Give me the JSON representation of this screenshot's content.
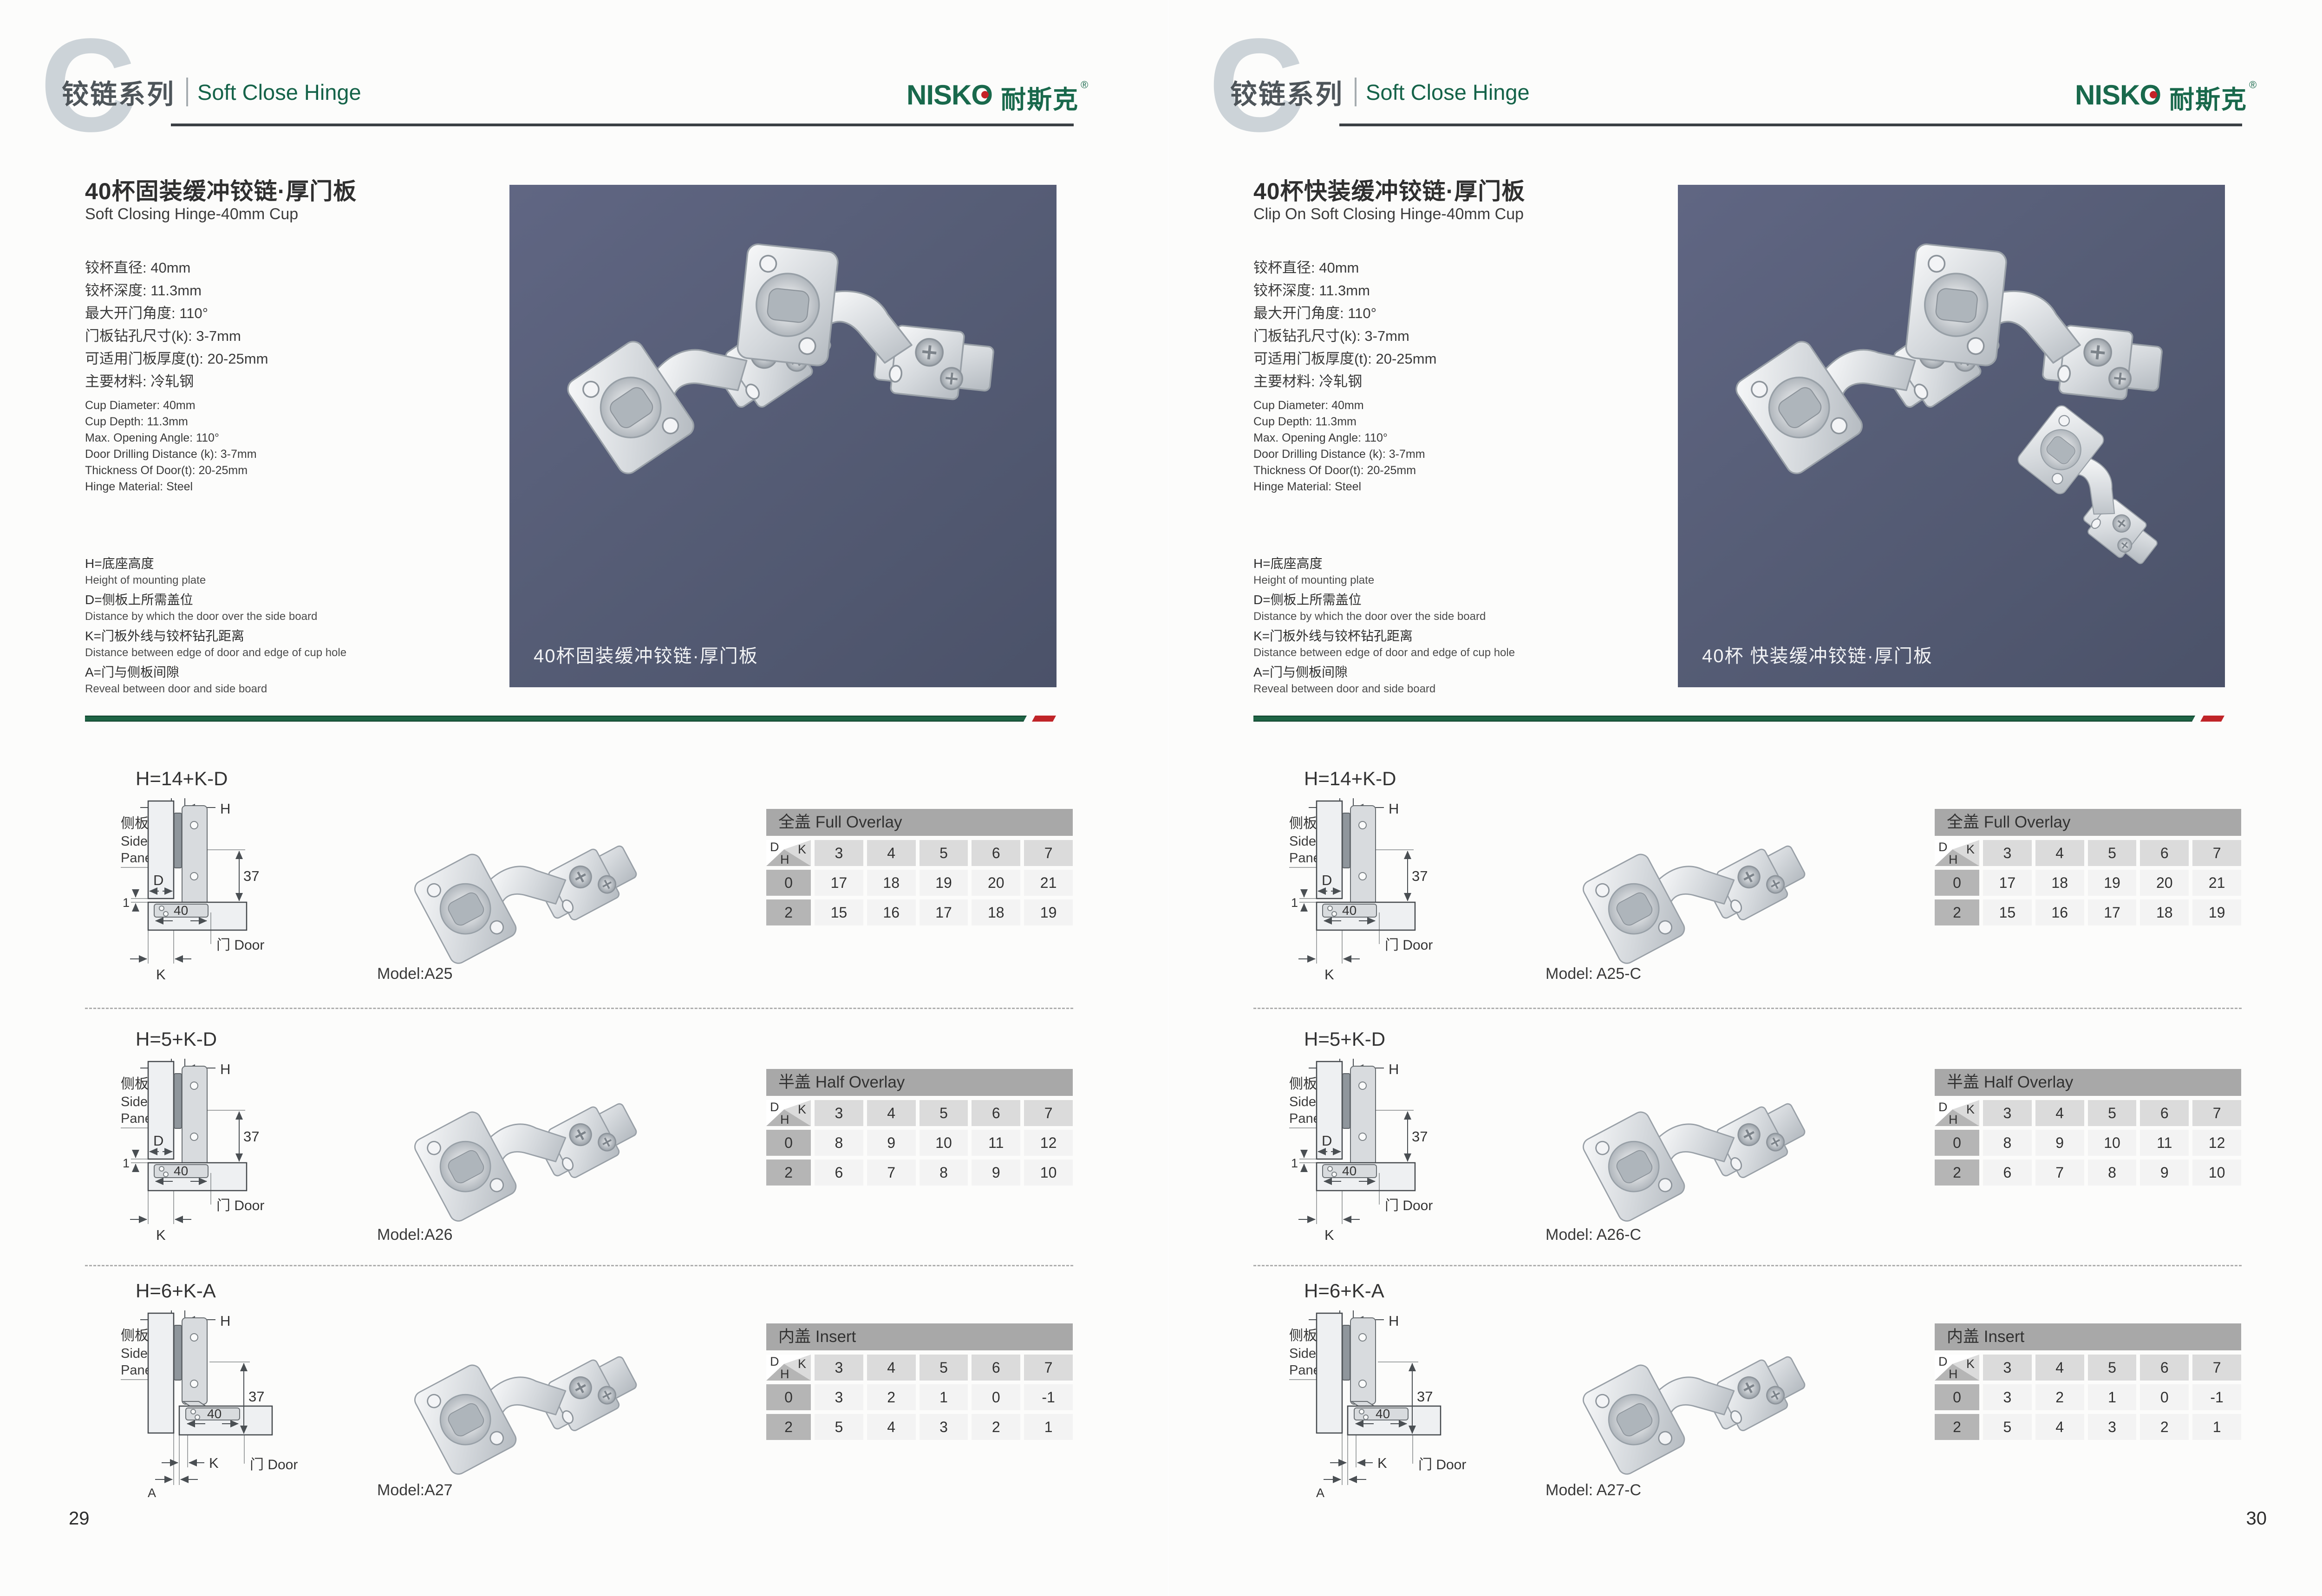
{
  "brand": {
    "name_en": "NISKO",
    "name_zh": "耐斯克",
    "registered": "®",
    "green": "#19694c",
    "red": "#c42127"
  },
  "corner": {
    "d": "D",
    "k": "K",
    "h": "H"
  },
  "diagram_labels": {
    "side_panel_zh": "侧板",
    "side_panel_en1": "Side",
    "side_panel_en2": "Panel",
    "door_zh": "门",
    "door_en": "Door",
    "h": "H",
    "d": "D",
    "k": "K",
    "a": "A",
    "one": "1",
    "dim37": "37",
    "dim40": "40"
  },
  "pages": [
    {
      "page_number": "29",
      "header": {
        "letter": "C",
        "series_zh": "铰链系列",
        "series_en": "Soft Close Hinge"
      },
      "product": {
        "title_zh": "40杯固装缓冲铰链·厚门板",
        "title_en": "Soft Closing Hinge-40mm Cup",
        "specs_zh": [
          "铰杯直径: 40mm",
          "铰杯深度: 11.3mm",
          "最大开门角度: 110°",
          "门板钻孔尺寸(k): 3-7mm",
          "可适用门板厚度(t): 20-25mm",
          "主要材料: 冷轧钢"
        ],
        "specs_en": [
          "Cup Diameter: 40mm",
          "Cup Depth: 11.3mm",
          "Max. Opening Angle: 110°",
          "Door Drilling Distance (k): 3-7mm",
          "Thickness Of Door(t): 20-25mm",
          "Hinge Material: Steel"
        ]
      },
      "legend": [
        {
          "zh": "H=底座高度",
          "en": "Height of mounting plate"
        },
        {
          "zh": "D=侧板上所需盖位",
          "en": "Distance by which the door over the side board"
        },
        {
          "zh": "K=门板外线与铰杯钻孔距离",
          "en": "Distance between edge of door and edge of cup hole"
        },
        {
          "zh": "A=门与侧板间隙",
          "en": "Reveal between door and side board"
        }
      ],
      "photo_caption": "40杯固装缓冲铰链·厚门板",
      "sections": [
        {
          "formula": "H=14+K-D",
          "diagram_variant": "overlay",
          "model": "Model:A25",
          "table": {
            "title_zh": "全盖",
            "title_en": "Full Overlay",
            "k_values": [
              3,
              4,
              5,
              6,
              7
            ],
            "rows": [
              {
                "h": "0",
                "values": [
                  17,
                  18,
                  19,
                  20,
                  21
                ]
              },
              {
                "h": "2",
                "values": [
                  15,
                  16,
                  17,
                  18,
                  19
                ]
              }
            ]
          }
        },
        {
          "formula": "H=5+K-D",
          "diagram_variant": "overlay",
          "model": "Model:A26",
          "table": {
            "title_zh": "半盖",
            "title_en": "Half Overlay",
            "k_values": [
              3,
              4,
              5,
              6,
              7
            ],
            "rows": [
              {
                "h": "0",
                "values": [
                  8,
                  9,
                  10,
                  11,
                  12
                ]
              },
              {
                "h": "2",
                "values": [
                  6,
                  7,
                  8,
                  9,
                  10
                ]
              }
            ]
          }
        },
        {
          "formula": "H=6+K-A",
          "diagram_variant": "insert",
          "model": "Model:A27",
          "table": {
            "title_zh": "内盖",
            "title_en": "Insert",
            "k_values": [
              3,
              4,
              5,
              6,
              7
            ],
            "rows": [
              {
                "h": "0",
                "values": [
                  3,
                  2,
                  1,
                  0,
                  -1
                ]
              },
              {
                "h": "2",
                "values": [
                  5,
                  4,
                  3,
                  2,
                  1
                ]
              }
            ]
          }
        }
      ]
    },
    {
      "page_number": "30",
      "header": {
        "letter": "C",
        "series_zh": "铰链系列",
        "series_en": "Soft Close Hinge"
      },
      "product": {
        "title_zh": "40杯快装缓冲铰链·厚门板",
        "title_en": "Clip On Soft Closing Hinge-40mm Cup",
        "specs_zh": [
          "铰杯直径: 40mm",
          "铰杯深度: 11.3mm",
          "最大开门角度: 110°",
          "门板钻孔尺寸(k): 3-7mm",
          "可适用门板厚度(t): 20-25mm",
          "主要材料: 冷轧钢"
        ],
        "specs_en": [
          "Cup Diameter: 40mm",
          "Cup Depth: 11.3mm",
          "Max. Opening Angle: 110°",
          "Door Drilling Distance (k): 3-7mm",
          "Thickness Of Door(t): 20-25mm",
          "Hinge Material: Steel"
        ]
      },
      "legend": [
        {
          "zh": "H=底座高度",
          "en": "Height of mounting plate"
        },
        {
          "zh": "D=侧板上所需盖位",
          "en": "Distance by which the door over the side board"
        },
        {
          "zh": "K=门板外线与铰杯钻孔距离",
          "en": "Distance between edge of door and edge of cup hole"
        },
        {
          "zh": "A=门与侧板间隙",
          "en": "Reveal between door and side board"
        }
      ],
      "photo_caption": "40杯 快装缓冲铰链·厚门板",
      "sections": [
        {
          "formula": "H=14+K-D",
          "diagram_variant": "overlay",
          "model": "Model: A25-C",
          "table": {
            "title_zh": "全盖",
            "title_en": "Full Overlay",
            "k_values": [
              3,
              4,
              5,
              6,
              7
            ],
            "rows": [
              {
                "h": "0",
                "values": [
                  17,
                  18,
                  19,
                  20,
                  21
                ]
              },
              {
                "h": "2",
                "values": [
                  15,
                  16,
                  17,
                  18,
                  19
                ]
              }
            ]
          }
        },
        {
          "formula": "H=5+K-D",
          "diagram_variant": "overlay",
          "model": "Model: A26-C",
          "table": {
            "title_zh": "半盖",
            "title_en": "Half Overlay",
            "k_values": [
              3,
              4,
              5,
              6,
              7
            ],
            "rows": [
              {
                "h": "0",
                "values": [
                  8,
                  9,
                  10,
                  11,
                  12
                ]
              },
              {
                "h": "2",
                "values": [
                  6,
                  7,
                  8,
                  9,
                  10
                ]
              }
            ]
          }
        },
        {
          "formula": "H=6+K-A",
          "diagram_variant": "insert",
          "model": "Model: A27-C",
          "table": {
            "title_zh": "内盖",
            "title_en": "Insert",
            "k_values": [
              3,
              4,
              5,
              6,
              7
            ],
            "rows": [
              {
                "h": "0",
                "values": [
                  3,
                  2,
                  1,
                  0,
                  -1
                ]
              },
              {
                "h": "2",
                "values": [
                  5,
                  4,
                  3,
                  2,
                  1
                ]
              }
            ]
          }
        }
      ]
    }
  ]
}
